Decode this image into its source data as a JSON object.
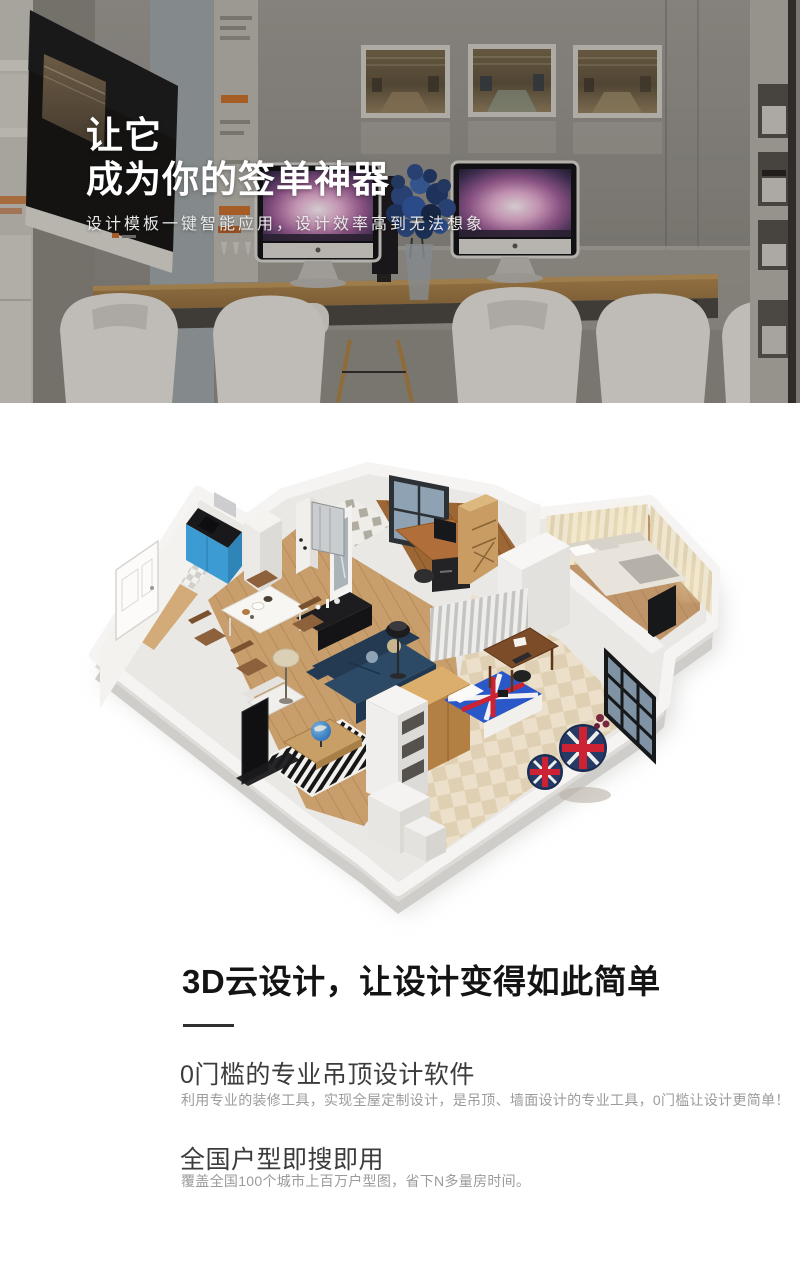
{
  "hero": {
    "title_line1": "让它",
    "title_line2": "成为你的签单神器",
    "subtitle": "设计模板一键智能应用，设计效率高到无法想象",
    "text_color": "#ffffff"
  },
  "features": {
    "heading": "3D云设计，让设计变得如此简单",
    "heading_color": "#141414",
    "divider_color": "#2f2f2f",
    "title_color": "#3c3c3c",
    "description_color": "#9b9b9b",
    "items": [
      {
        "title": "0门槛的专业吊顶设计软件",
        "description": "利用专业的装修工具，实现全屋定制设计，是吊顶、墙面设计的专业工具，0门槛让设计更简单！"
      },
      {
        "title": "全国户型即搜即用",
        "description": "覆盖全国100个城市上百万户型图，省下N多量房时间。"
      }
    ]
  }
}
